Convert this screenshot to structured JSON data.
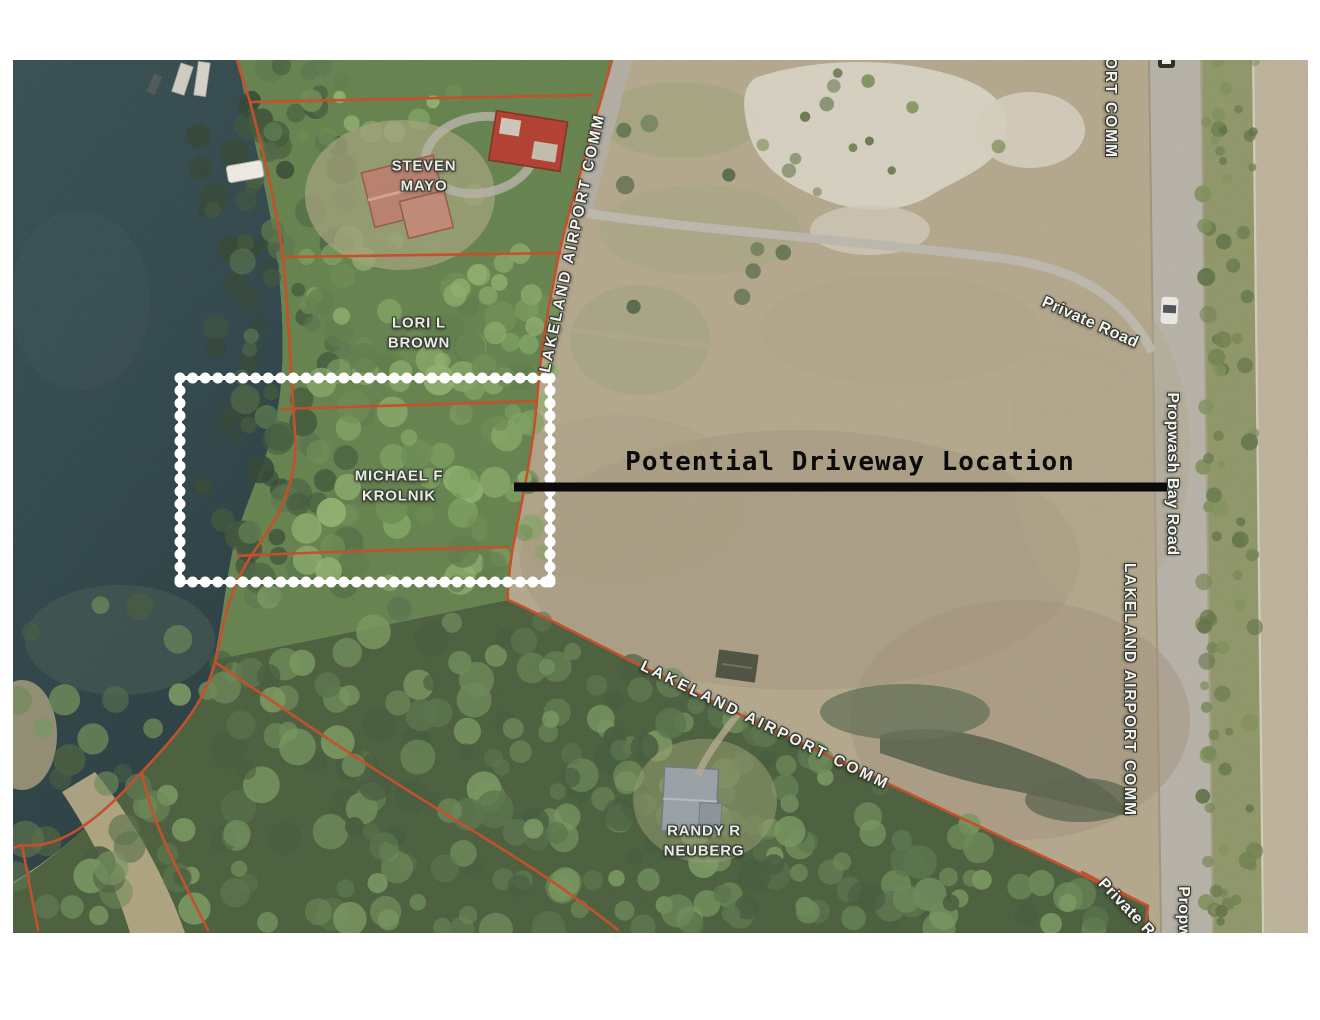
{
  "annotation": {
    "driveway_label": "Potential Driveway Location"
  },
  "parcel_labels": {
    "steven_mayo": "STEVEN\nMAYO",
    "lori_brown": "LORI L\nBROWN",
    "michael_krolnik": "MICHAEL F\nKROLNIK",
    "randy_neuberg": "RANDY R\nNEUBERG"
  },
  "road_labels": {
    "private_road": "Private Road",
    "propwash_bay_road": "Propwash Bay Road",
    "ort_comm_fragment": "ORT COMM",
    "private_road_fragment": "Private R",
    "propwash_fragment": "Propw"
  },
  "boundary_labels": {
    "top": "LAKELAND AIRPORT COMM",
    "right": "LAKELAND AIRPORT COMM",
    "bottom": "LAKELAND AIRPORT COMM"
  },
  "colors": {
    "parcel_line": "#c4502c",
    "highlight_border": "#ffffff",
    "driveway_line": "#0a0a0a"
  }
}
